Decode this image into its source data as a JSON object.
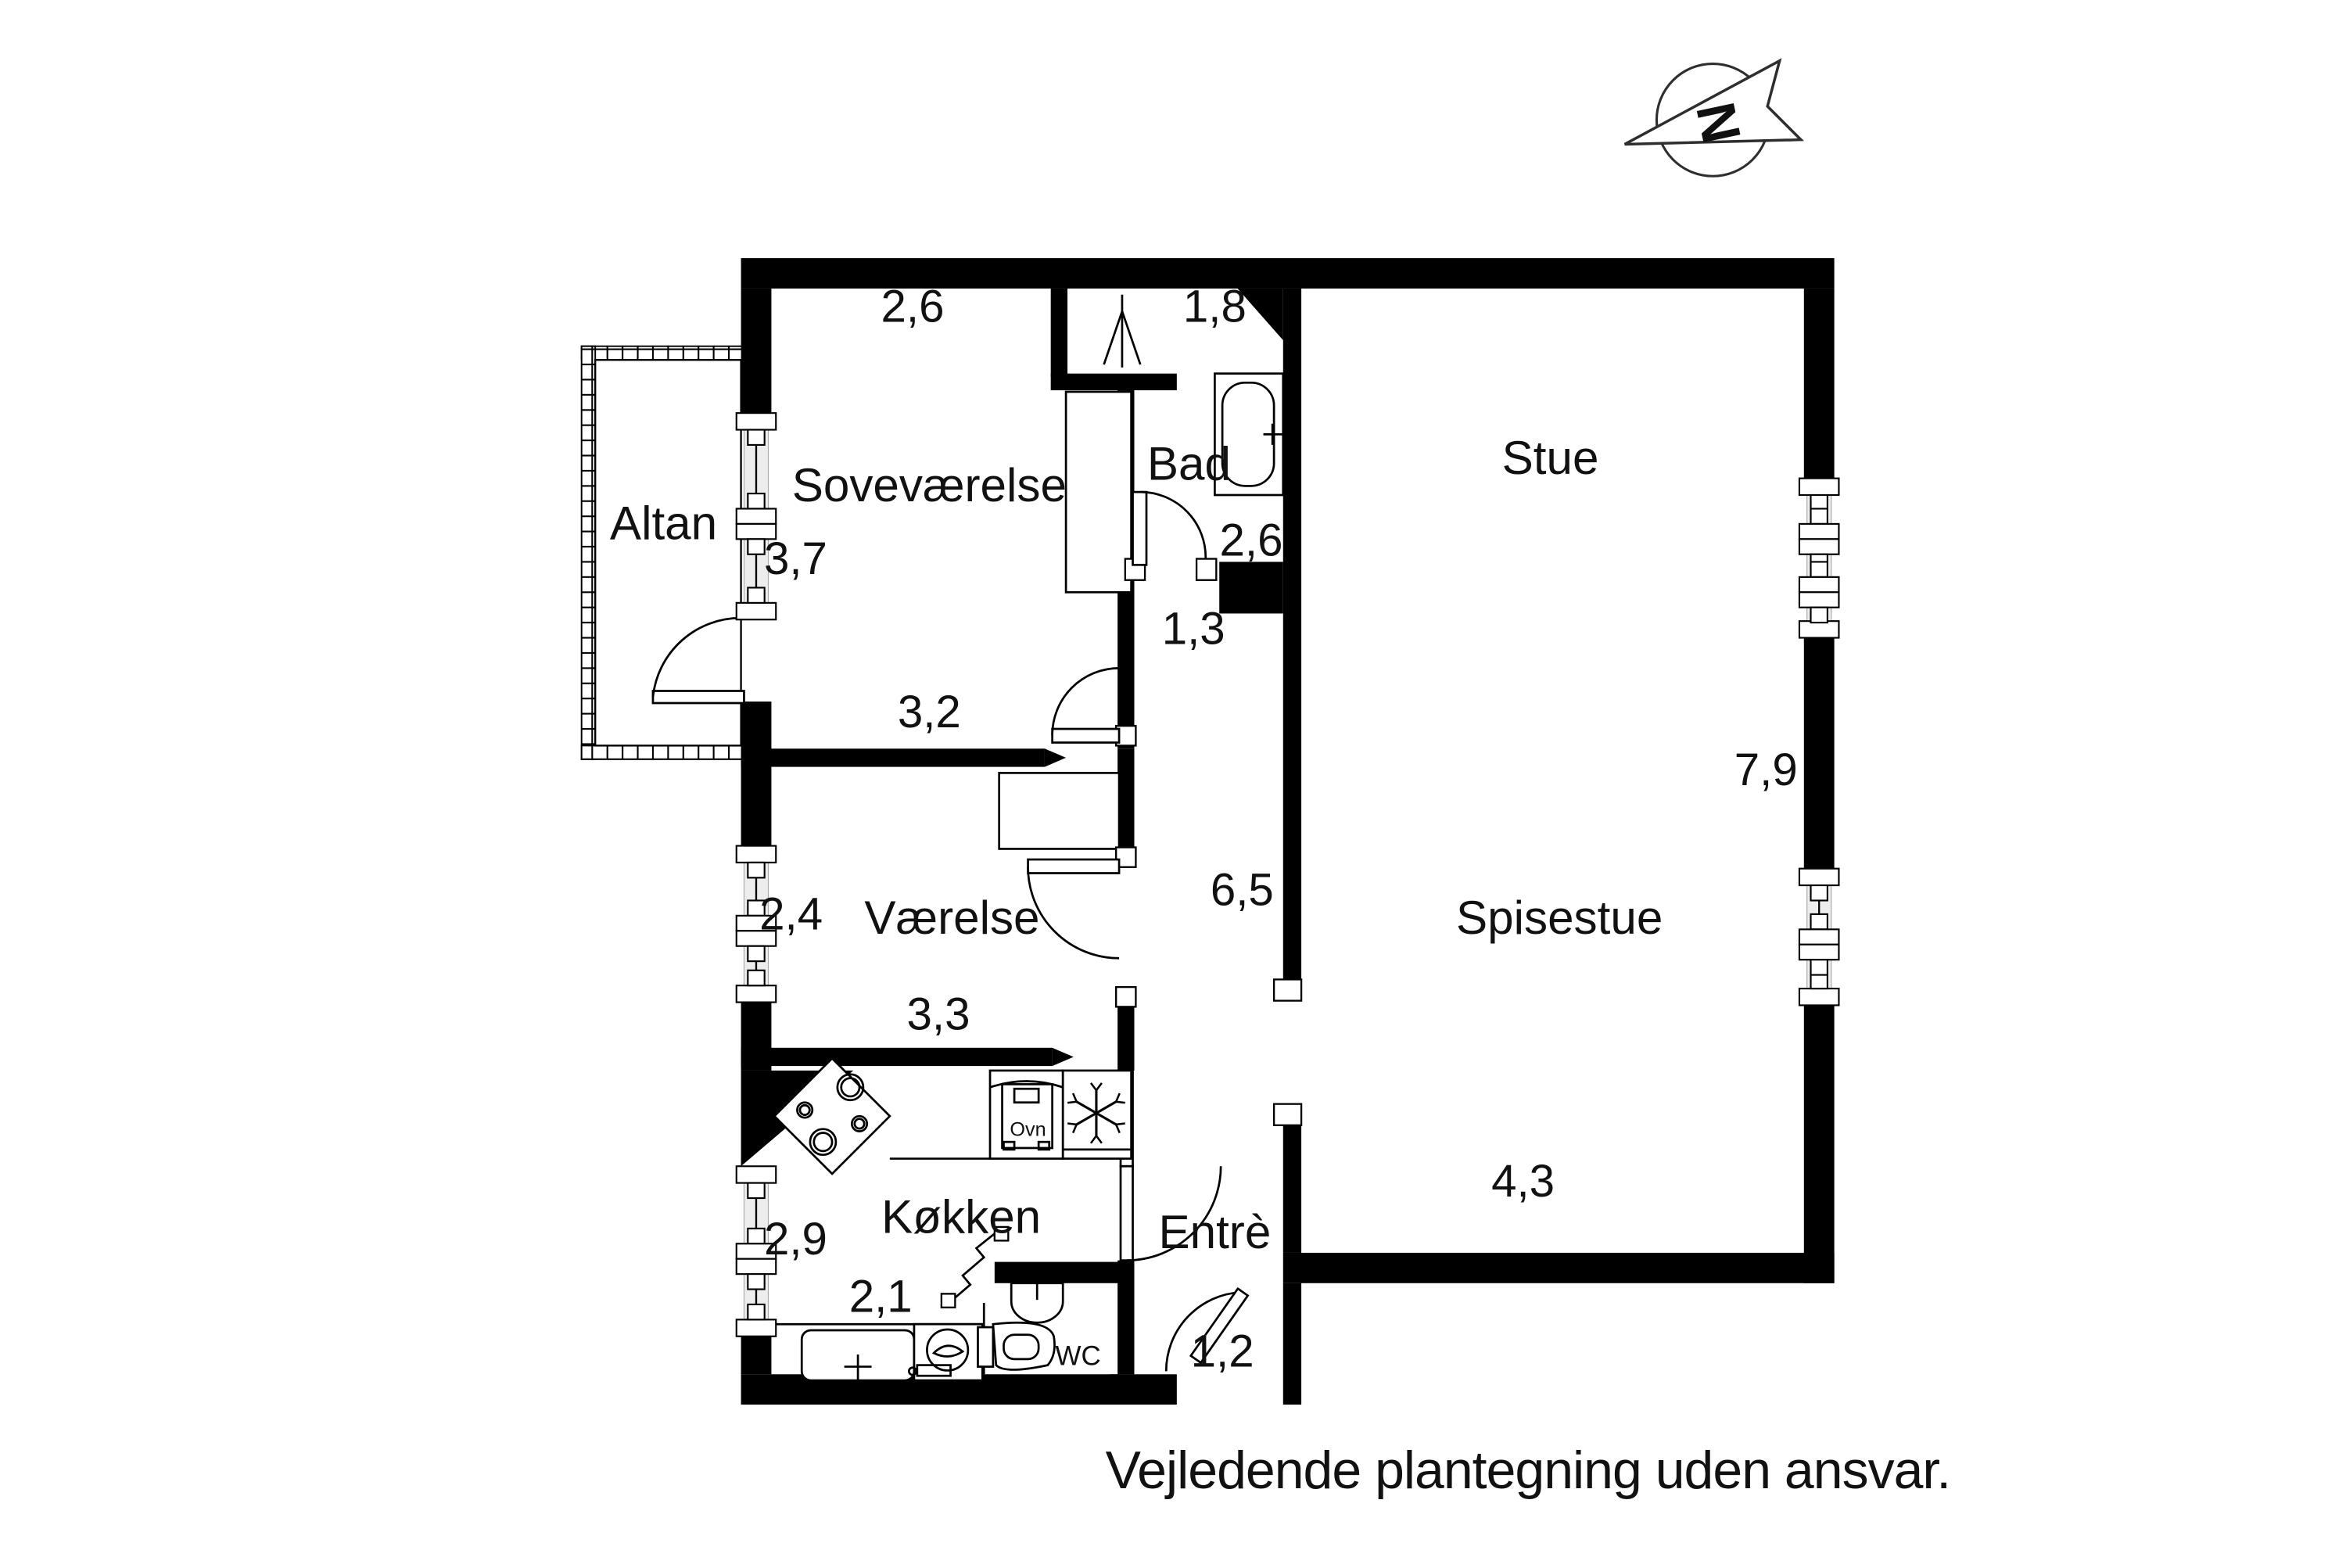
{
  "plan": {
    "footer": {
      "text": "Vejledende plantegning uden ansvar."
    },
    "compass": {
      "letter": "N",
      "direction": "north-left"
    },
    "rooms": {
      "altan": {
        "label": "Altan"
      },
      "sovevaerelse": {
        "label": "Soveværelse"
      },
      "bad": {
        "label": "Bad"
      },
      "stue": {
        "label": "Stue"
      },
      "vaerelse": {
        "label": "Værelse"
      },
      "spisestue": {
        "label": "Spisestue"
      },
      "koekken": {
        "label": "Køkken"
      },
      "entre": {
        "label": "Entrè"
      },
      "wc": {
        "label": "WC"
      }
    },
    "dims": {
      "sovevaerelse_width": "2,6",
      "bad_width": "1,8",
      "sovevaerelse_depth": "3,7",
      "bad_height": "2,6",
      "hall_niche": "1,3",
      "sovevaerelse_bottom": "3,2",
      "vaerelse_height": "2,4",
      "vaerelse_width": "3,3",
      "corridor_length": "6,5",
      "stue_side": "7,9",
      "koekken_height": "2,9",
      "koekken_width": "2,1",
      "spisestue_width": "4,3",
      "entre_door": "1,2"
    },
    "fixtures": {
      "oven_label": "Ovn"
    },
    "icons": {
      "compass": "north-arrow-icon",
      "vent": "vent-icon",
      "bathtub": "bathtub-icon",
      "stove": "stove-burners-icon",
      "oven": "oven-icon",
      "freezer": "snowflake-icon",
      "sink": "kitchen-sink-icon",
      "washer": "washing-machine-icon",
      "hand_basin": "hand-basin-icon",
      "toilet": "toilet-icon"
    },
    "colors": {
      "wall": "#000000",
      "background": "#ffffff",
      "window_band": "#ededed",
      "text": "#111111"
    }
  }
}
